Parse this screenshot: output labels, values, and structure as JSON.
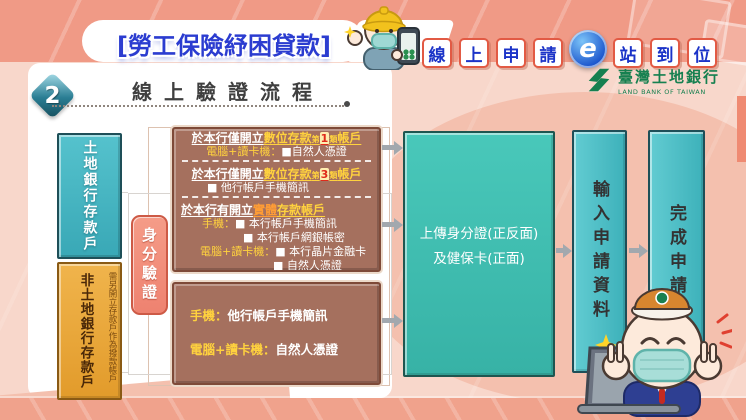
{
  "colors": {
    "page_bg": "#f8d7cb",
    "header_bg": "#f09a86",
    "blob": "#f4c0ae",
    "bottom_band": "#f0a28c",
    "coral_strip": "#ef8a72",
    "brown_box": "#a5705e",
    "brown_border": "#7e4a38",
    "pink_verify_border": "#cd5a46",
    "yellow_text": "#ffd23e",
    "orange_text": "#ff9c35",
    "red_num": "#e02a1a",
    "blue_title": "#2b3cd0",
    "slogan_border": "#e25a44",
    "slogan_blue": "#1b33c8",
    "green_logo": "#168050",
    "arrow": "#a2a8ae",
    "heading_text": "#3f3f3f"
  },
  "header": {
    "title": "[勞工保險紓困貸款]",
    "slogan": {
      "chars_left": [
        "線",
        "上",
        "申",
        "請"
      ],
      "e_label": "e",
      "chars_right": [
        "站",
        "到",
        "位"
      ]
    },
    "bank": {
      "name_zh": "臺灣土地銀行",
      "name_en": "LAND BANK OF TAIWAN"
    }
  },
  "section": {
    "number": "2",
    "title": "線上驗證流程"
  },
  "flow": {
    "depositor_landbank": "土地銀行存款戶",
    "depositor_other": "非土地銀行存款戶",
    "depositor_other_note": "需另開立存款戶作為撥款帳戶",
    "identity_verify": "身分驗證",
    "upload_line1": "上傳身分證(正反面)",
    "upload_line2": "及健保卡(正面)",
    "enter_info": "輸入申請資料",
    "complete": "完成申請",
    "box1_lines": [
      {
        "type": "hc",
        "name": "digital-account-type1-header",
        "segs": [
          {
            "t": "於本行僅開立",
            "s": "w"
          },
          {
            "t": "數位存款",
            "s": "y"
          },
          {
            "t": "第",
            "s": "sm"
          },
          {
            "t": "1",
            "s": "num"
          },
          {
            "t": "類",
            "s": "sm"
          },
          {
            "t": "帳戶",
            "s": "y"
          }
        ]
      },
      {
        "type": "ic",
        "name": "type1-method",
        "segs": [
          {
            "t": "電腦+讀卡機：",
            "s": "y"
          },
          {
            "t": "■自然人憑證",
            "s": "w"
          }
        ]
      },
      {
        "type": "divider",
        "name": "dashed-divider"
      },
      {
        "type": "hc",
        "name": "digital-account-type3-header",
        "segs": [
          {
            "t": "於本行僅開立",
            "s": "w"
          },
          {
            "t": "數位存款",
            "s": "y"
          },
          {
            "t": "第",
            "s": "sm"
          },
          {
            "t": "3",
            "s": "num"
          },
          {
            "t": "類",
            "s": "sm"
          },
          {
            "t": "帳戶",
            "s": "y"
          }
        ]
      },
      {
        "type": "il",
        "pl": 30,
        "name": "type3-method",
        "segs": [
          {
            "t": "■ 他行帳戶手機簡訊",
            "s": "w"
          }
        ]
      },
      {
        "type": "divider",
        "name": "dashed-divider"
      },
      {
        "type": "hl",
        "name": "physical-account-header",
        "segs": [
          {
            "t": "於本行有開立",
            "s": "w"
          },
          {
            "t": "實體",
            "s": "o"
          },
          {
            "t": "存款帳戶",
            "s": "y"
          }
        ]
      },
      {
        "type": "il",
        "pl": 25,
        "name": "physical-method-phone-1",
        "segs": [
          {
            "t": "手機：",
            "s": "y"
          },
          {
            "t": "■ 本行帳戶手機簡訊",
            "s": "w"
          }
        ]
      },
      {
        "type": "il",
        "pl": 66,
        "name": "physical-method-phone-2",
        "segs": [
          {
            "t": "■ 本行帳戶網銀帳密",
            "s": "w"
          }
        ]
      },
      {
        "type": "il",
        "pl": 23,
        "name": "physical-method-pc-1",
        "segs": [
          {
            "t": "電腦+讀卡機：",
            "s": "y"
          },
          {
            "t": "■ 本行晶片金融卡",
            "s": "w"
          }
        ]
      },
      {
        "type": "il",
        "pl": 96,
        "name": "physical-method-pc-2",
        "segs": [
          {
            "t": "■ 自然人憑證",
            "s": "w"
          }
        ]
      }
    ],
    "box2_lines": [
      {
        "type": "b2",
        "name": "other-bank-method-phone",
        "segs": [
          {
            "t": "手機：",
            "s": "y"
          },
          {
            "t": "他行帳戶手機簡訊",
            "s": "w"
          }
        ]
      },
      {
        "type": "b2",
        "name": "other-bank-method-pc",
        "segs": [
          {
            "t": "電腦+讀卡機：",
            "s": "y"
          },
          {
            "t": "自然人憑證",
            "s": "w"
          }
        ]
      }
    ]
  },
  "icons": {
    "worker_mascot": "construction-worker-with-mask-holding-phone",
    "bank_mascot": "bank-clerk-with-mask-victory-signs-laptop",
    "e_badge": "blue-e-circle-logo",
    "bank_logo": "land-bank-green-emblem",
    "sparkle": "yellow-sparkle-star",
    "arrow": "gray-flow-arrow"
  }
}
